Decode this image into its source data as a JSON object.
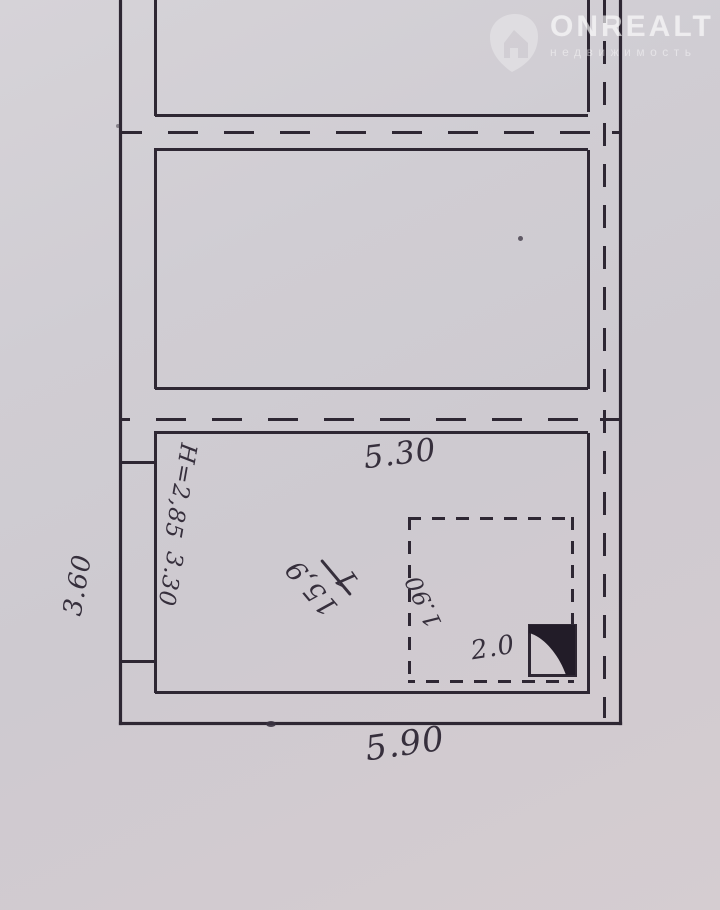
{
  "watermark": {
    "brand": "ONREALT",
    "subtitle": "недвижимость",
    "logo_icon": "map-pin-house-icon"
  },
  "plan": {
    "type": "floor-plan-scan",
    "labels": {
      "width_top": "5.30",
      "width_bottom": "5.90",
      "height_left": "3.60",
      "ceiling_height": "Н=2,85",
      "wall_segment": "3.30",
      "niche_depth": "1.90",
      "stove_width": "2.0"
    },
    "room_label": {
      "number": "1",
      "area": "15,9"
    },
    "colors": {
      "paper": "#d0cdd3",
      "ink": "#2e2733",
      "watermark_text": "rgba(255,255,255,0.55)"
    }
  }
}
